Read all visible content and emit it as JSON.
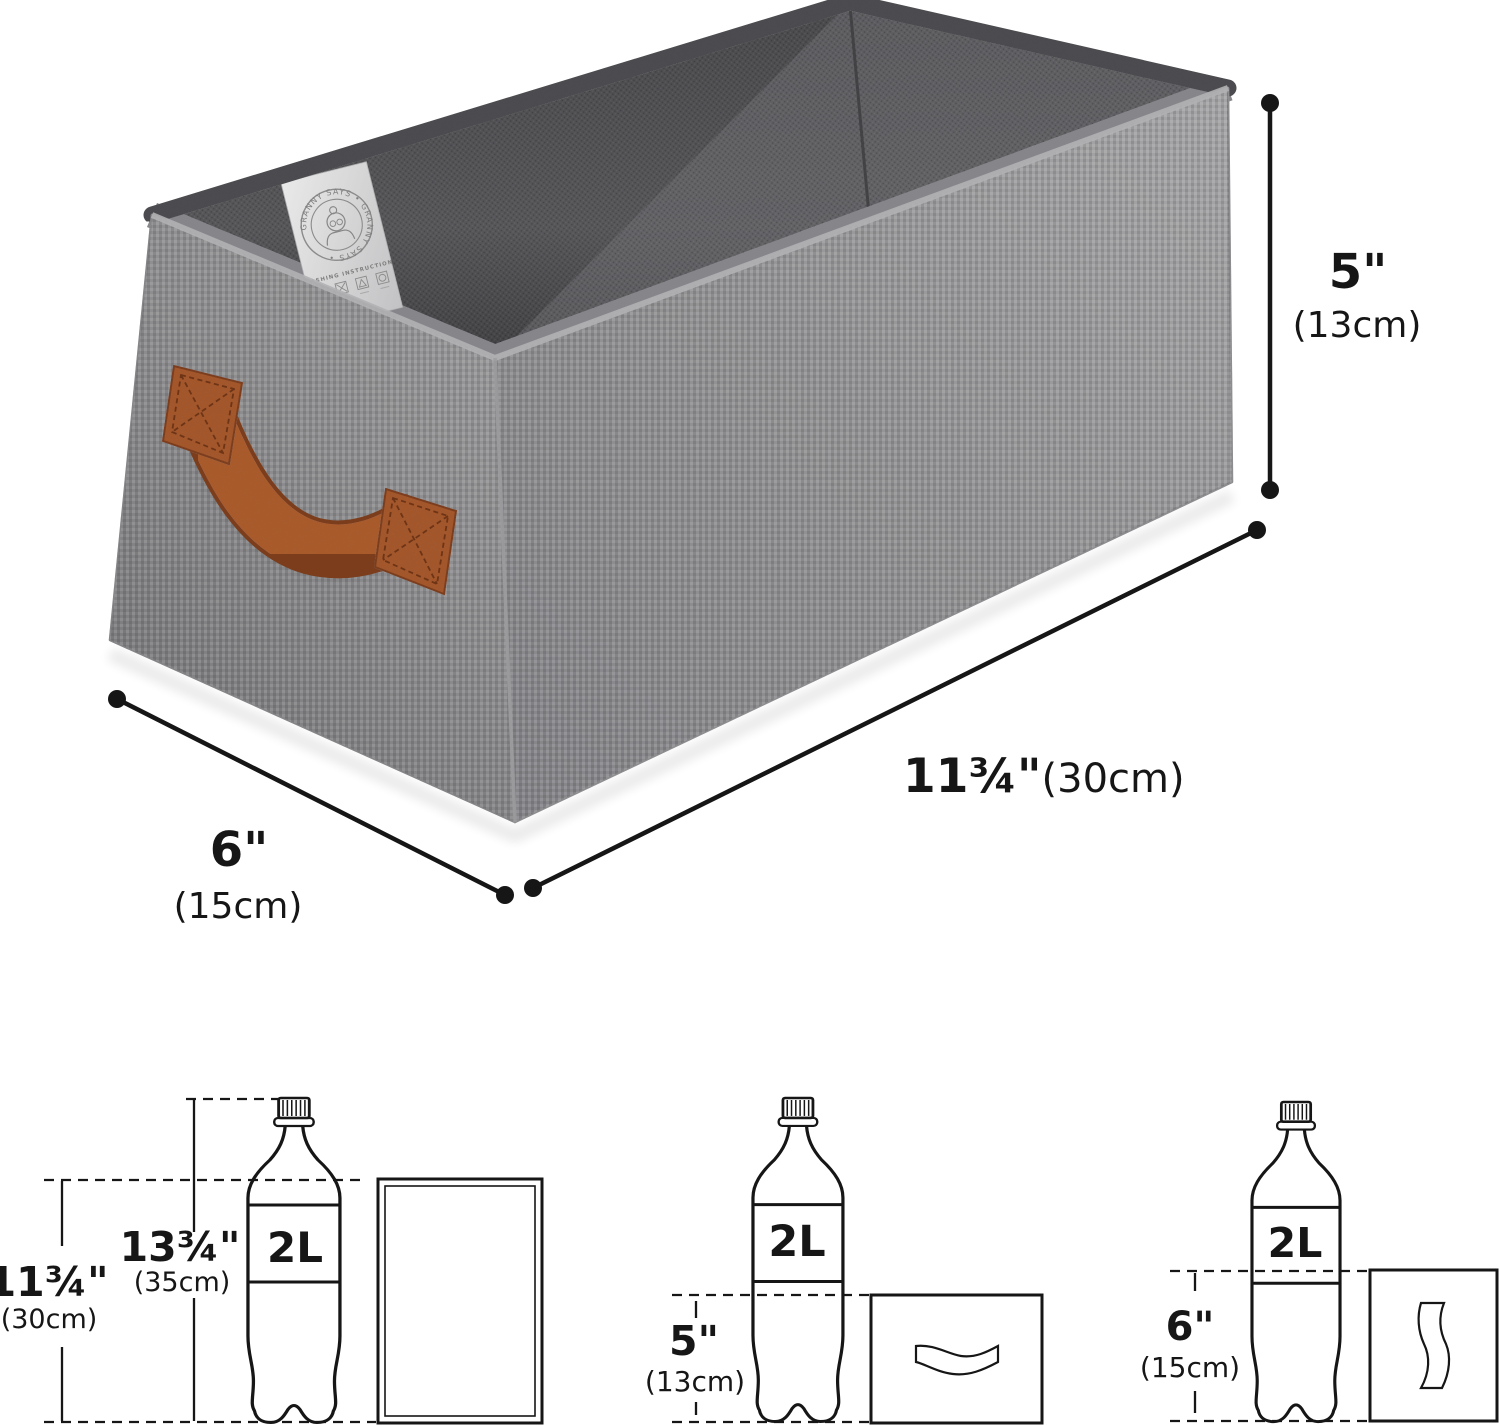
{
  "image": {
    "description": "Gray fabric storage basket with brown leather handle shown with dimension annotations and 2L bottle size comparison diagrams",
    "background": "#ffffff",
    "ink": "#161616"
  },
  "colors": {
    "fabric_light": "#a3a3a5",
    "fabric_mid": "#8f8f91",
    "fabric_dark": "#7f7f82",
    "rim_dark": "#4c4c4f",
    "interior_wall": "#545457",
    "interior_wall_light": "#6e6e71",
    "interior_fold": "#85858a",
    "handle_brown": "#a85a2c",
    "handle_brown_dark": "#7b3d1b",
    "tag_silver": "#d9d9d9"
  },
  "basket": {
    "tag": {
      "circular_text": "GRANNY SAYS • GRANNY SAYS •",
      "instruction": "WASHING INSTRUCTION"
    }
  },
  "annotations": {
    "height": {
      "imperial": "5\"",
      "metric": "(13cm)"
    },
    "length": {
      "imperial": "11¾\"",
      "metric": "(30cm)"
    },
    "width": {
      "imperial": "6\"",
      "metric": "(15cm)"
    }
  },
  "comparison": {
    "bottle_label": "2L",
    "left": {
      "bottle_height": {
        "imperial": "13¾\"",
        "metric": "(35cm)"
      },
      "box_height": {
        "imperial": "11¾\"",
        "metric": "(30cm)"
      }
    },
    "middle": {
      "box_height": {
        "imperial": "5\"",
        "metric": "(13cm)"
      }
    },
    "right": {
      "box_height": {
        "imperial": "6\"",
        "metric": "(15cm)"
      }
    }
  }
}
